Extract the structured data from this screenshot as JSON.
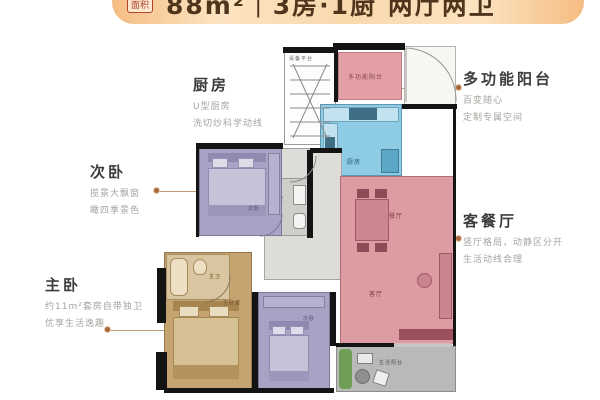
{
  "banner": {
    "badge": "面积",
    "title": "88m²｜3房·1厨 两厅两卫"
  },
  "callouts": {
    "kitchen": {
      "title": "厨房",
      "lines": [
        "U型厨房",
        "洗切炒科学动线"
      ]
    },
    "second_bedroom": {
      "title": "次卧",
      "lines": [
        "揽景大飘窗",
        "瞰四季景色"
      ]
    },
    "master_bedroom": {
      "title": "主卧",
      "lines": [
        "约11m²套房自带独卫",
        "优享生活逸趣"
      ]
    },
    "multi_balcony": {
      "title": "多功能阳台",
      "lines": [
        "百变随心",
        "定制专属空间"
      ]
    },
    "living_dining": {
      "title": "客餐厅",
      "lines": [
        "竖厅格局，动静区分开",
        "生活动线合理"
      ]
    }
  },
  "rooms": {
    "equipment_platform": "设备平台",
    "multi_balcony": "多功能阳台",
    "kitchen": "厨房",
    "dining": "餐厅",
    "living": "客厅",
    "guest_bath": "客卫",
    "second_bedroom": "次卧",
    "master_bath": "主卫",
    "master_bedroom": "主卧室",
    "third_bedroom": "次卧",
    "life_balcony": "生活阳台"
  },
  "colors": {
    "banner_orange": "#f5bd83",
    "balcony_pink": "#e2a0a6",
    "kitchen_cyan": "#8ecbe4",
    "living_red": "#dd9ba2",
    "bedroom_lavender": "#a7a3c5",
    "master_tan": "#c5a472",
    "utility_gray": "#b9b9b7",
    "wall_black": "#141414"
  }
}
